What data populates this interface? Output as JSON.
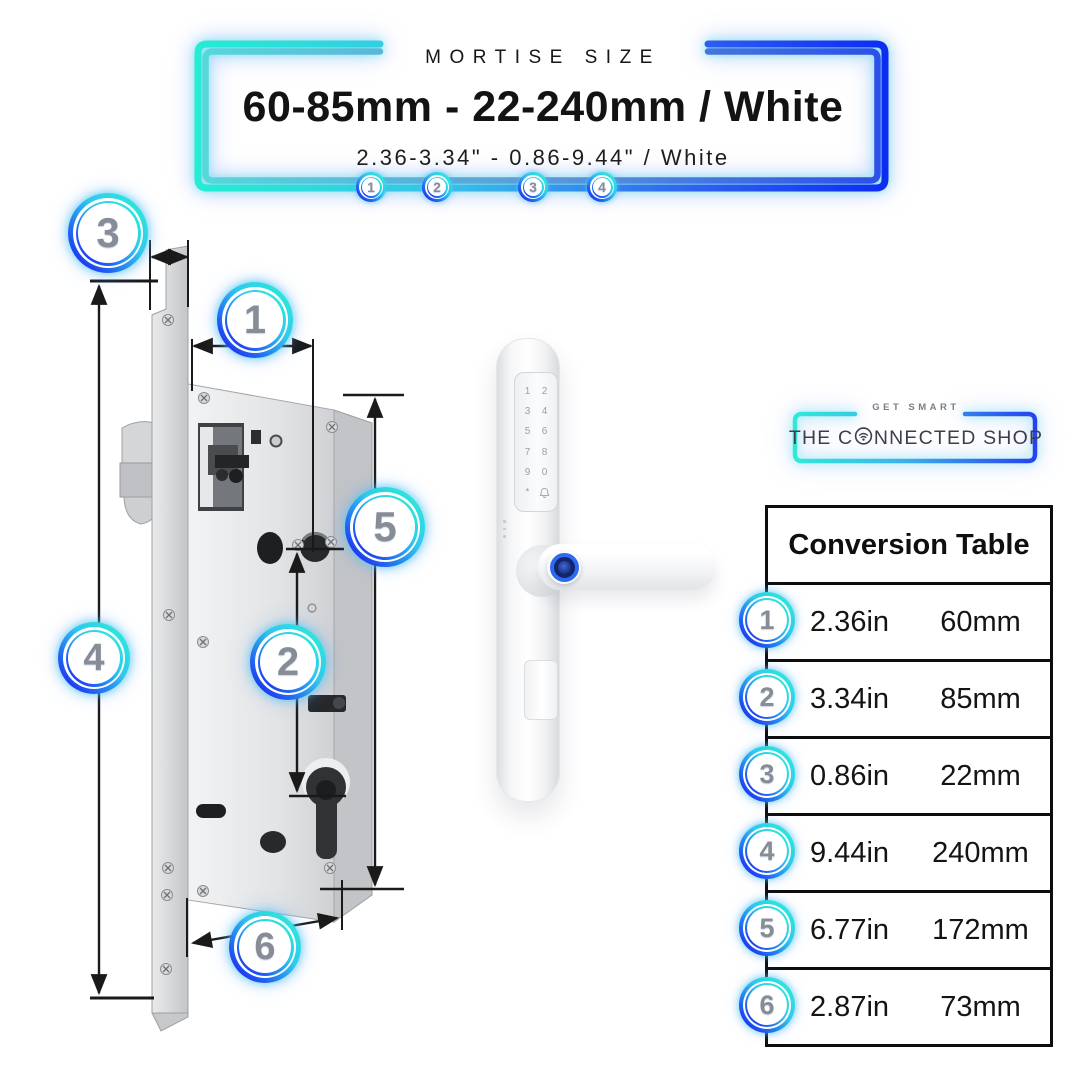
{
  "banner": {
    "eyebrow": "MORTISE SIZE",
    "title": "60-85mm - 22-240mm / White",
    "subtitle": "2.36-3.34\" - 0.86-9.44\" / White",
    "markers": [
      "1",
      "2",
      "3",
      "4"
    ]
  },
  "diagram": {
    "callouts": [
      "1",
      "2",
      "3",
      "4",
      "5",
      "6"
    ]
  },
  "handle": {
    "keypad": [
      "1",
      "2",
      "3",
      "4",
      "5",
      "6",
      "7",
      "8",
      "9",
      "0",
      "*"
    ]
  },
  "logo": {
    "tagline": "GET SMART",
    "name_part1": "THE C",
    "name_part2": "NNECTED SHOP"
  },
  "table": {
    "title": "Conversion Table",
    "rows": [
      {
        "marker": "1",
        "inches": "2.36in",
        "mm": "60mm"
      },
      {
        "marker": "2",
        "inches": "3.34in",
        "mm": "85mm"
      },
      {
        "marker": "3",
        "inches": "0.86in",
        "mm": "22mm"
      },
      {
        "marker": "4",
        "inches": "9.44in",
        "mm": "240mm"
      },
      {
        "marker": "5",
        "inches": "6.77in",
        "mm": "172mm"
      },
      {
        "marker": "6",
        "inches": "2.87in",
        "mm": "73mm"
      }
    ]
  },
  "icons": {
    "doorbell": "bell-icon",
    "wifi_o": "wifi-icon",
    "fingerprint": "fingerprint-sensor"
  },
  "colors": {
    "accent_cyan": "#2DEDD6",
    "accent_blue": "#1B34F2",
    "accent_mid": "#5B9BD8",
    "number_gray": "#878D96",
    "line_black": "#1A1A1A"
  }
}
